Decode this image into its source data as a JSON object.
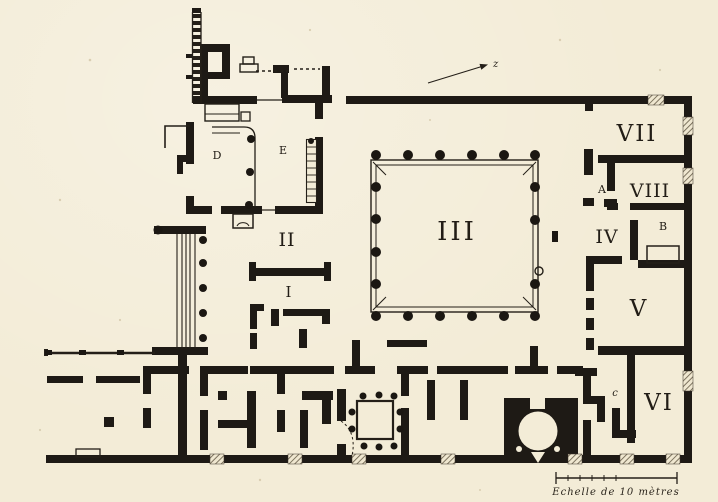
{
  "figure": {
    "kind": "engraved architectural floor plan",
    "subject": "Plan of an excavated Roman house complex with colonnaded peristyle, shops and bakery oven",
    "paper_color": "#f3ecd7",
    "ink_color": "#1e1a15"
  },
  "labels": {
    "room_I": "I",
    "room_II": "II",
    "room_III": "III",
    "room_IV": "IV",
    "room_V": "V",
    "room_VI": "VI",
    "room_VII": "VII",
    "room_VIII": "VIII",
    "room_A": "A",
    "room_B": "B",
    "room_c": "c",
    "room_D": "D",
    "room_E": "E",
    "north_arrow": "z",
    "scale_caption": "Echelle de 10 mètres"
  }
}
